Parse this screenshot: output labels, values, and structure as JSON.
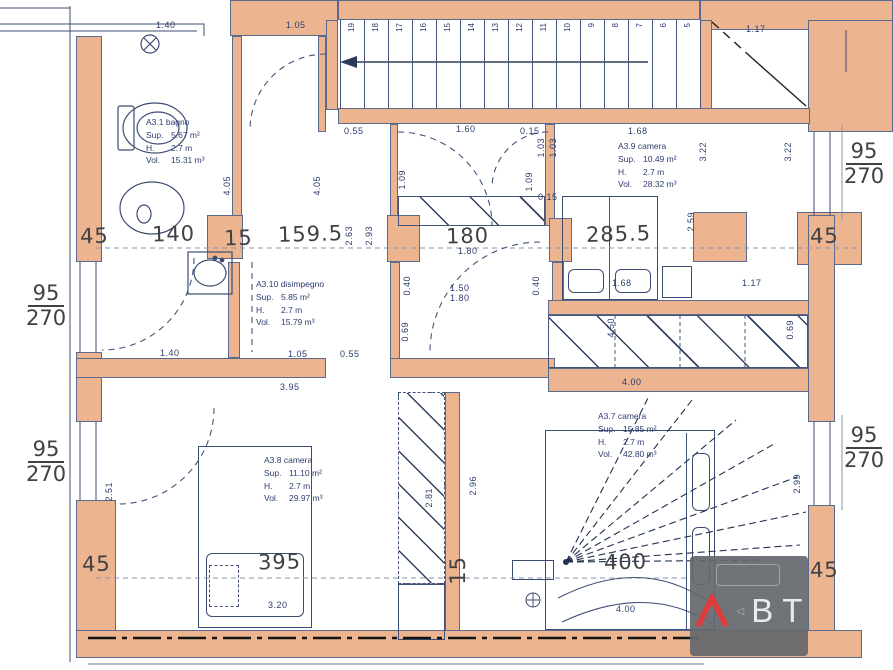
{
  "colors": {
    "wall_fill": "#ecb58f",
    "plot_line": "#3c4c72",
    "blueprint_text": "#2c3d6e",
    "handwritten_text": "#3f4145",
    "logo_red": "#e23b3b",
    "logo_gray": "#64676c"
  },
  "rooms": [
    {
      "name": "bagno",
      "x": 146,
      "y": 116,
      "title": "A3.1 bagno",
      "rows": [
        [
          "Sup.",
          "5.67 m²"
        ],
        [
          "H.",
          "2.7 m"
        ],
        [
          "Vol.",
          "15.31 m³"
        ]
      ]
    },
    {
      "name": "disimpegno",
      "x": 256,
      "y": 278,
      "title": "A3.10 disimpegno",
      "rows": [
        [
          "Sup.",
          "5.85 m²"
        ],
        [
          "H.",
          "2.7 m"
        ],
        [
          "Vol.",
          "15.79 m³"
        ]
      ]
    },
    {
      "name": "camera-a3-9",
      "x": 618,
      "y": 140,
      "title": "A3.9 camera",
      "rows": [
        [
          "Sup.",
          "10.49 m²"
        ],
        [
          "H.",
          "2.7 m"
        ],
        [
          "Vol.",
          "28.32 m³"
        ]
      ]
    },
    {
      "name": "camera-a3-7",
      "x": 598,
      "y": 410,
      "title": "A3.7 camera",
      "rows": [
        [
          "Sup.",
          "15.85 m²"
        ],
        [
          "H.",
          "2.7 m"
        ],
        [
          "Vol.",
          "42.80 m³"
        ]
      ]
    },
    {
      "name": "camera-a3-8",
      "x": 264,
      "y": 454,
      "title": "A3.8 camera",
      "rows": [
        [
          "Sup.",
          "11.10 m²"
        ],
        [
          "H.",
          "2.7 m"
        ],
        [
          "Vol.",
          "29.97 m³"
        ]
      ]
    }
  ],
  "dimensions": {
    "handwritten": [
      {
        "t": "45",
        "x": 80,
        "y": 224
      },
      {
        "t": "140",
        "x": 152,
        "y": 222
      },
      {
        "t": "15",
        "x": 224,
        "y": 226
      },
      {
        "t": "159.5",
        "x": 278,
        "y": 222
      },
      {
        "t": "180",
        "x": 446,
        "y": 224
      },
      {
        "t": "285.5",
        "x": 586,
        "y": 222
      },
      {
        "t": "45",
        "x": 810,
        "y": 224
      },
      {
        "t": "45",
        "x": 82,
        "y": 552
      },
      {
        "t": "395",
        "x": 258,
        "y": 550
      },
      {
        "t": "15",
        "x": 446,
        "y": 556,
        "r": -90
      },
      {
        "t": "400",
        "x": 604,
        "y": 550
      },
      {
        "t": "45",
        "x": 810,
        "y": 558
      }
    ],
    "blueprint": [
      {
        "t": "1.40",
        "x": 156,
        "y": 20
      },
      {
        "t": "1.05",
        "x": 286,
        "y": 20
      },
      {
        "t": "1.17",
        "x": 746,
        "y": 24
      },
      {
        "t": "0.55",
        "x": 344,
        "y": 126
      },
      {
        "t": "1.60",
        "x": 456,
        "y": 124
      },
      {
        "t": "0.15",
        "x": 520,
        "y": 126
      },
      {
        "t": "1.68",
        "x": 628,
        "y": 126
      },
      {
        "t": "3.22",
        "x": 698,
        "y": 142,
        "r": -90
      },
      {
        "t": "3.22",
        "x": 783,
        "y": 142,
        "r": -90
      },
      {
        "t": "4.05",
        "x": 222,
        "y": 176,
        "r": -90
      },
      {
        "t": "4.05",
        "x": 312,
        "y": 176,
        "r": -90
      },
      {
        "t": "1.09",
        "x": 397,
        "y": 170,
        "r": -90
      },
      {
        "t": "1.09",
        "x": 524,
        "y": 172,
        "r": -90
      },
      {
        "t": "1.03",
        "x": 536,
        "y": 138,
        "r": -90
      },
      {
        "t": "1.03",
        "x": 548,
        "y": 138,
        "r": -90
      },
      {
        "t": "0.15",
        "x": 538,
        "y": 192
      },
      {
        "t": "2.59",
        "x": 686,
        "y": 212,
        "r": -90
      },
      {
        "t": "2.63",
        "x": 344,
        "y": 226,
        "r": -90
      },
      {
        "t": "2.93",
        "x": 364,
        "y": 226,
        "r": -90
      },
      {
        "t": "1.80",
        "x": 458,
        "y": 246
      },
      {
        "t": "1.68",
        "x": 612,
        "y": 278
      },
      {
        "t": "1.17",
        "x": 742,
        "y": 278
      },
      {
        "t": "1.40",
        "x": 160,
        "y": 348
      },
      {
        "t": "1.05",
        "x": 288,
        "y": 349
      },
      {
        "t": "0.55",
        "x": 340,
        "y": 349
      },
      {
        "t": "0.40",
        "x": 402,
        "y": 276,
        "r": -90
      },
      {
        "t": "1.50",
        "x": 450,
        "y": 283
      },
      {
        "t": "1.80",
        "x": 450,
        "y": 293
      },
      {
        "t": "0.40",
        "x": 531,
        "y": 276,
        "r": -90
      },
      {
        "t": "0.69",
        "x": 400,
        "y": 322,
        "r": -90
      },
      {
        "t": "4.50",
        "x": 606,
        "y": 318,
        "r": -90
      },
      {
        "t": "0.69",
        "x": 785,
        "y": 320,
        "r": -90
      },
      {
        "t": "4.00",
        "x": 622,
        "y": 377
      },
      {
        "t": "3.95",
        "x": 280,
        "y": 382
      },
      {
        "t": "2.51",
        "x": 104,
        "y": 482,
        "r": -90
      },
      {
        "t": "2.81",
        "x": 424,
        "y": 488,
        "r": -90
      },
      {
        "t": "2.96",
        "x": 468,
        "y": 476,
        "r": -90
      },
      {
        "t": "2.99",
        "x": 792,
        "y": 474,
        "r": -90
      },
      {
        "t": "3.20",
        "x": 268,
        "y": 600
      },
      {
        "t": "4.00",
        "x": 616,
        "y": 604
      }
    ],
    "window_tags": [
      {
        "num": "95",
        "den": "270",
        "x": 26,
        "y": 282
      },
      {
        "num": "95",
        "den": "270",
        "x": 26,
        "y": 438
      },
      {
        "num": "95",
        "den": "270",
        "x": 844,
        "y": 140
      },
      {
        "num": "95",
        "den": "270",
        "x": 844,
        "y": 424
      }
    ]
  },
  "stairs": {
    "numbers": [
      "19",
      "18",
      "17",
      "16",
      "15",
      "14",
      "13",
      "12",
      "11",
      "10",
      "9",
      "8",
      "7",
      "6",
      "5"
    ]
  },
  "logo": {
    "letters": [
      "B",
      "T"
    ],
    "arrow_glyph": "◁"
  }
}
